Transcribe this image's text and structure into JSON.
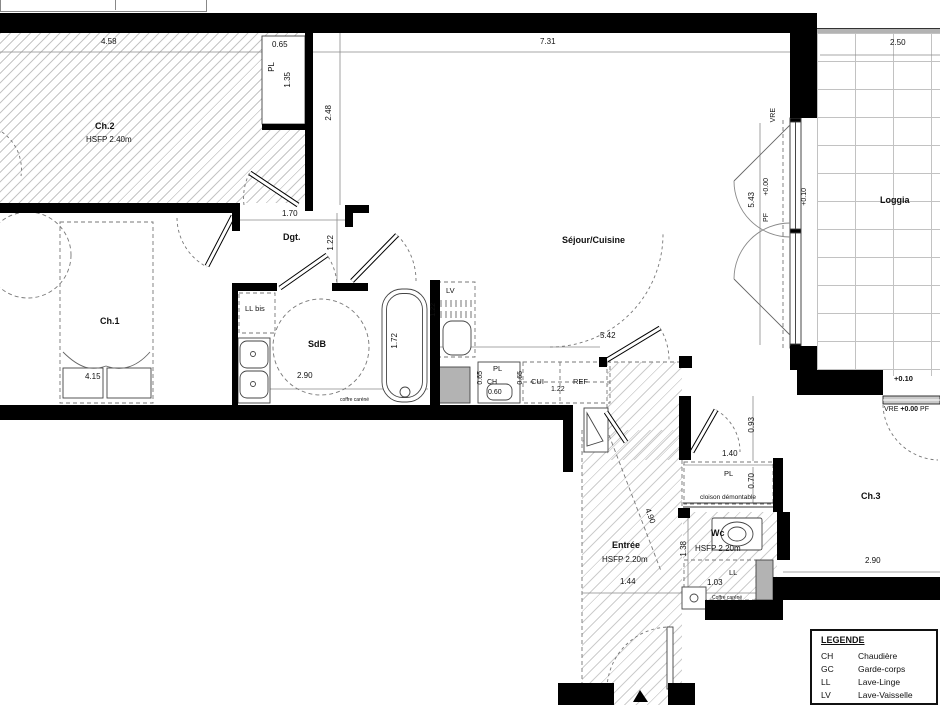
{
  "plan": {
    "rooms": {
      "ch2": {
        "name": "Ch.2",
        "ceiling": "HSFP 2.40m"
      },
      "ch1": {
        "name": "Ch.1"
      },
      "dgt": {
        "name": "Dgt."
      },
      "sdb": {
        "name": "SdB"
      },
      "sejour_cuisine": {
        "name": "Séjour/Cuisine"
      },
      "loggia": {
        "name": "Loggia"
      },
      "entree": {
        "name": "Entrée",
        "ceiling": "HSFP 2.20m"
      },
      "wc": {
        "name": "Wc",
        "ceiling": "HSFP 2.20m"
      },
      "ch3": {
        "name": "Ch.3"
      }
    },
    "dimensions": {
      "ch2_width": "4.58",
      "ch2_pl_width": "0.65",
      "ch2_pl_depth": "1.35",
      "sejour_width": "7.31",
      "sejour_depth": "2.48",
      "sejour_length": "5.42",
      "loggia_width": "2.50",
      "loggia_length": "5.43",
      "dgt_width": "1.70",
      "dgt_depth": "1.22",
      "ch1_width": "4.15",
      "sdb_width": "2.90",
      "sdb_bath_length": "1.72",
      "lv_width": "1.22",
      "kitchen_pl_depth": "0.65",
      "kitchen_ch_width": "0.60",
      "kitchen_cui_depth": "0.65",
      "kitchen_cui_width": "1.22",
      "hall_depth": "0.93",
      "wc_pl_width": "1.40",
      "wc_pl_depth": "0.70",
      "entree_diag": "4.90",
      "entree_width": "1.44",
      "wc_depth": "1.38",
      "wc_width": "1.03",
      "ch3_width": "2.90"
    },
    "fixtures": {
      "pl_ch2": "PL",
      "ll_bis": "LL bis",
      "lv": "LV",
      "pl_kitchen": "PL",
      "ch": "CH",
      "cui": "CUI",
      "ref": "REF",
      "pl_wc": "PL",
      "ll": "LL",
      "cloison": "cloison démontable",
      "coffre_sdb": "coffre caréné",
      "coffre_wc": "Coffre caréné"
    },
    "levels": {
      "vre_left": "VRE",
      "pf_left": "PF",
      "lvl_000_left": "+0.00",
      "lvl_010_left": "+0.10",
      "lvl_010_right": "+0.10",
      "vre_right": "VRE",
      "lvl_000_right": "+0.00",
      "pf_right": "PF"
    }
  },
  "legend": {
    "title": "LEGENDE",
    "r1_abbr": "CH",
    "r1_label": "Chaudière",
    "r2_abbr": "GC",
    "r2_label": "Garde-corps",
    "r3_abbr": "LL",
    "r3_label": "Lave-Linge",
    "r4_abbr": "LV",
    "r4_label": "Lave-Vaisselle",
    "r5_abbr": "CUI",
    "r5_label": "Cuisson"
  }
}
